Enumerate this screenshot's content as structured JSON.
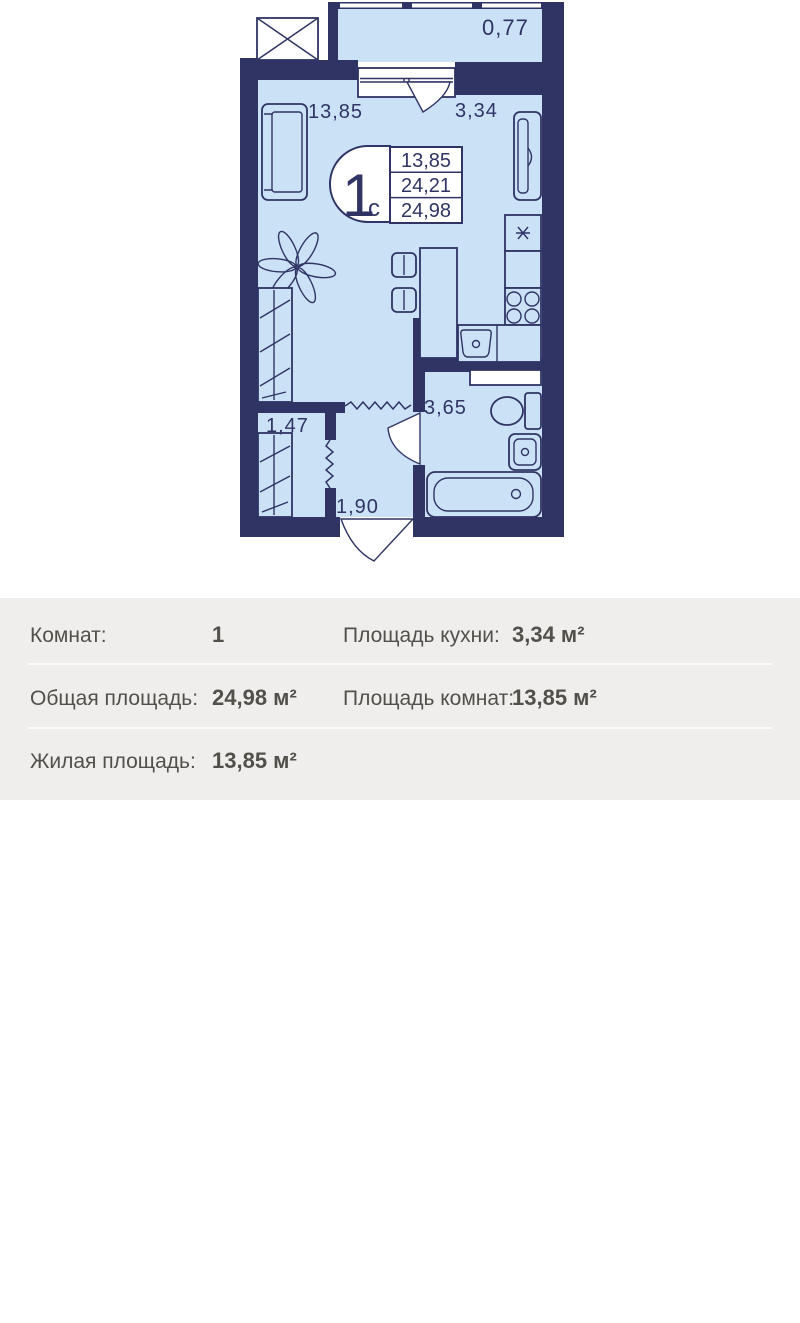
{
  "colors": {
    "wall": "#2f3464",
    "room-fill": "#cbe1f6",
    "paper": "#ffffff",
    "panel-bg": "#efeeec",
    "text": "#53504b",
    "separator": "#fbfbfa",
    "watermark": "rgba(255,255,255,0.55)"
  },
  "plan": {
    "balcony_area": "0,77",
    "room_area": "13,85",
    "kitchen_area": "3,34",
    "bathroom_area": "3,65",
    "closet_area": "1,47",
    "hall_area": "1,90",
    "stamp": {
      "rooms": "1",
      "suffix": "с",
      "row1": "13,85",
      "row2": "24,21",
      "row3": "24,98"
    }
  },
  "info": {
    "rows_left": [
      {
        "label": "Комнат:",
        "value": "1"
      },
      {
        "label": "Общая площадь:",
        "value": "24,98 м²"
      },
      {
        "label": "Жилая площадь:",
        "value": "13,85 м²"
      }
    ],
    "rows_right": [
      {
        "label": "Площадь кухни:",
        "value": "3,34 м²"
      },
      {
        "label": "Площадь комнат:",
        "value": "13,85 м²"
      }
    ]
  },
  "watermark": {
    "brand": "циан",
    "id": "13975368"
  }
}
